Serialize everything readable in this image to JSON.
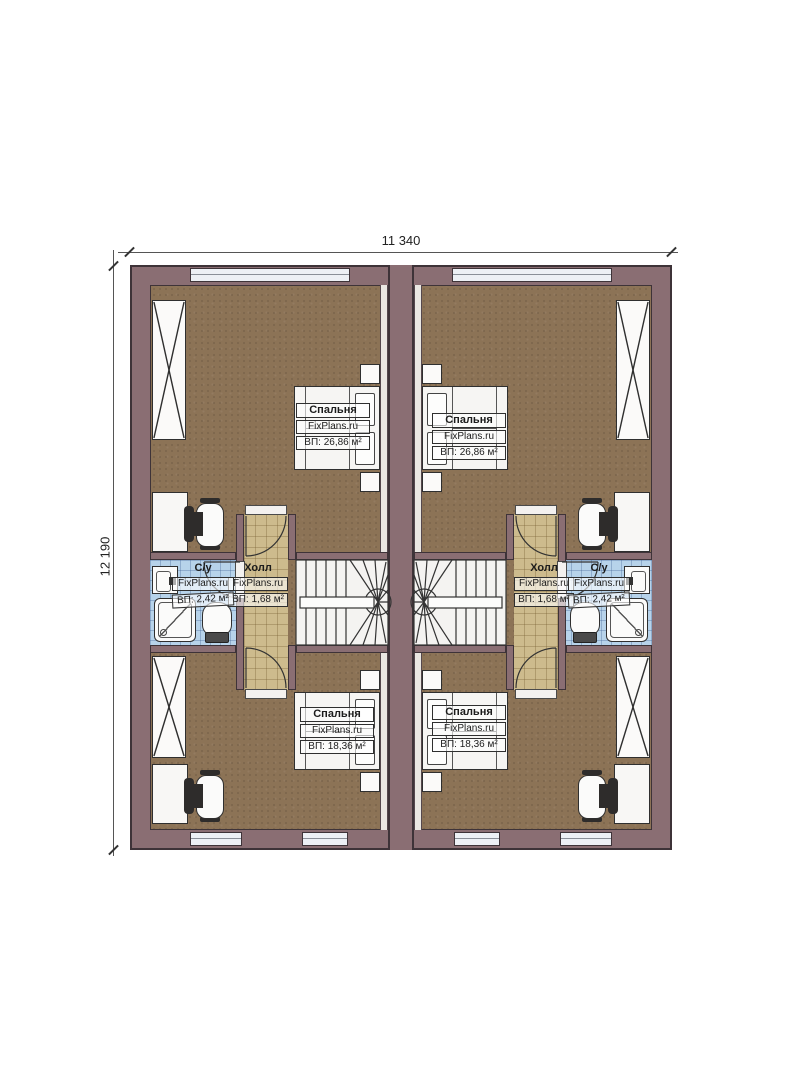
{
  "palette": {
    "wall": "#8a6e73",
    "outline": "#3e3338",
    "floor": "#8c7356",
    "hall_tile": "#cdbb8d",
    "bath_tile": "#b7d3ea",
    "window": "#edf0f5"
  },
  "dimensions": {
    "top": "11 340",
    "left": "12 190"
  },
  "site": {
    "watermark": "FixPlans.ru"
  },
  "rooms": {
    "bedroom_tl": {
      "name": "Спальня",
      "area": "ВП: 26,86 м²"
    },
    "bedroom_tr": {
      "name": "Спальня",
      "area": "ВП: 26,86 м²"
    },
    "bedroom_bl": {
      "name": "Спальня",
      "area": "ВП: 18,36 м²"
    },
    "bedroom_br": {
      "name": "Спальня",
      "area": "ВП: 18,36 м²"
    },
    "hall_left": {
      "name": "Холл",
      "area": "ВП: 1,68 м²"
    },
    "hall_right": {
      "name": "Холл",
      "area": "ВП: 1,68 м²"
    },
    "wc_left": {
      "name": "С/у",
      "area": "ВП: 2,42 м²"
    },
    "wc_right": {
      "name": "С/у",
      "area": "ВП: 2,42 м²"
    }
  }
}
